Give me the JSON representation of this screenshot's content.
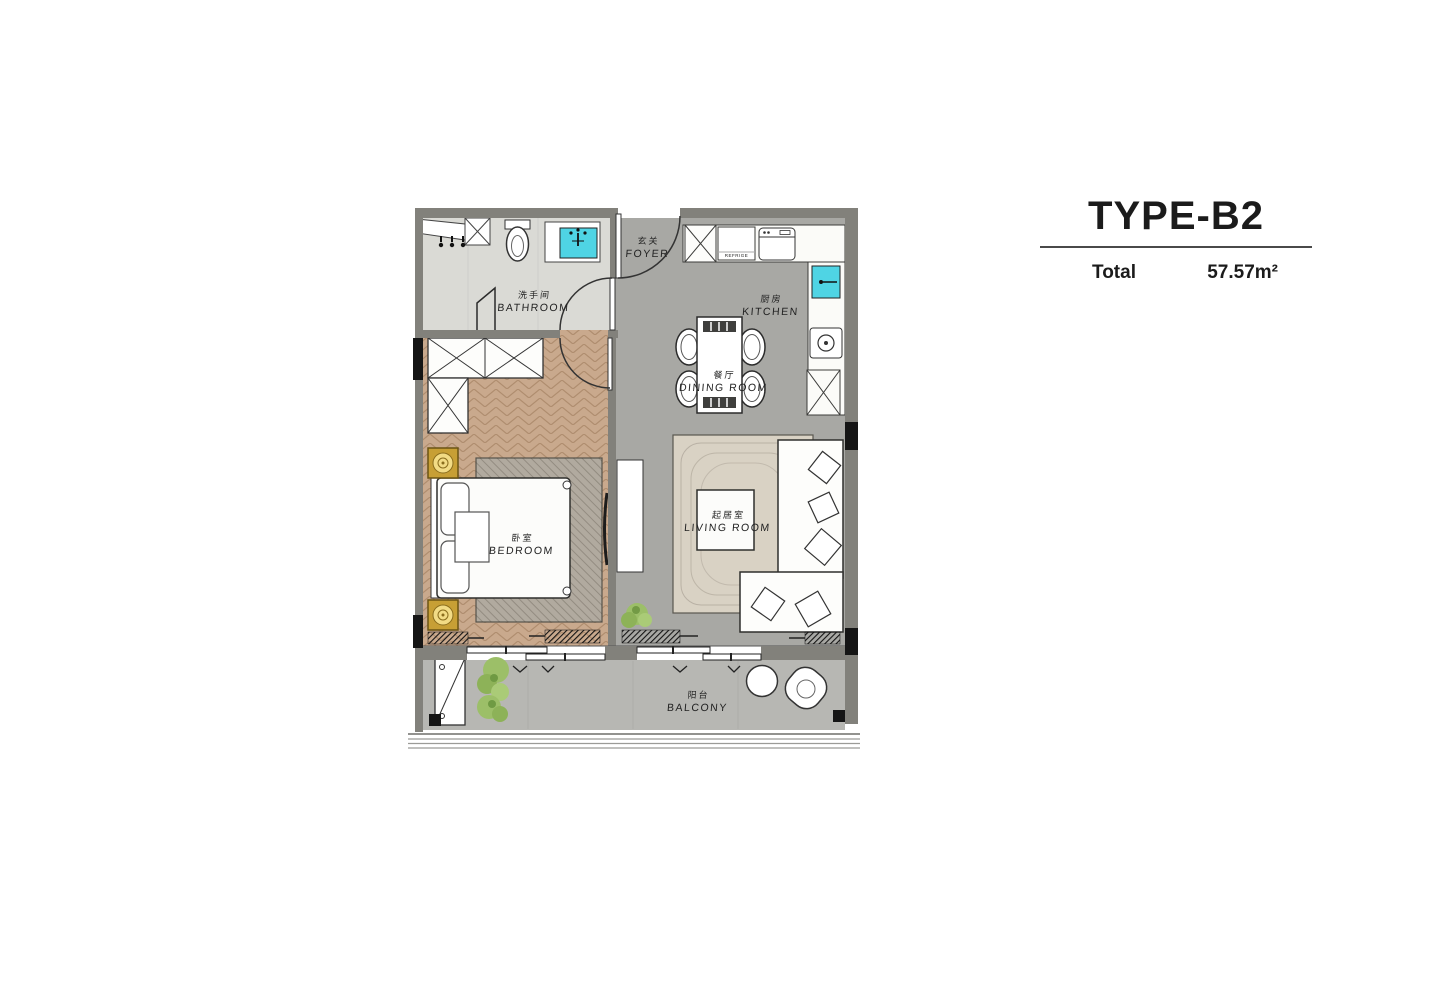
{
  "title_block": {
    "type_label": "TYPE-B2",
    "total_label": "Total",
    "area_value": "57.57m²"
  },
  "rooms": [
    {
      "id": "foyer",
      "name_zh": "玄关",
      "name_en": "FOYER"
    },
    {
      "id": "bathroom",
      "name_zh": "洗手间",
      "name_en": "BATHROOM"
    },
    {
      "id": "kitchen",
      "name_zh": "厨房",
      "name_en": "KITCHEN"
    },
    {
      "id": "dining-room",
      "name_zh": "餐厅",
      "name_en": "DINING ROOM"
    },
    {
      "id": "bedroom",
      "name_zh": "卧室",
      "name_en": "BEDROOM"
    },
    {
      "id": "living-room",
      "name_zh": "起居室",
      "name_en": "LIVING ROOM"
    },
    {
      "id": "balcony",
      "name_zh": "阳台",
      "name_en": "BALCONY"
    }
  ],
  "appliance_labels": {
    "refrigerator": "REFRIGE"
  },
  "colors": {
    "wall": "#82817b",
    "wall_dark": "#151515",
    "floor_gray": "#a8a8a4",
    "floor_bathroom": "#dadad5",
    "floor_wood": "#c9a98d",
    "floor_balcony": "#b7b7b3",
    "counter_white": "#fbfbf8",
    "fixture_cyan": "#4fd4e4",
    "nightstand_gold": "#c79f35",
    "plant_green": "#9cbf68"
  }
}
